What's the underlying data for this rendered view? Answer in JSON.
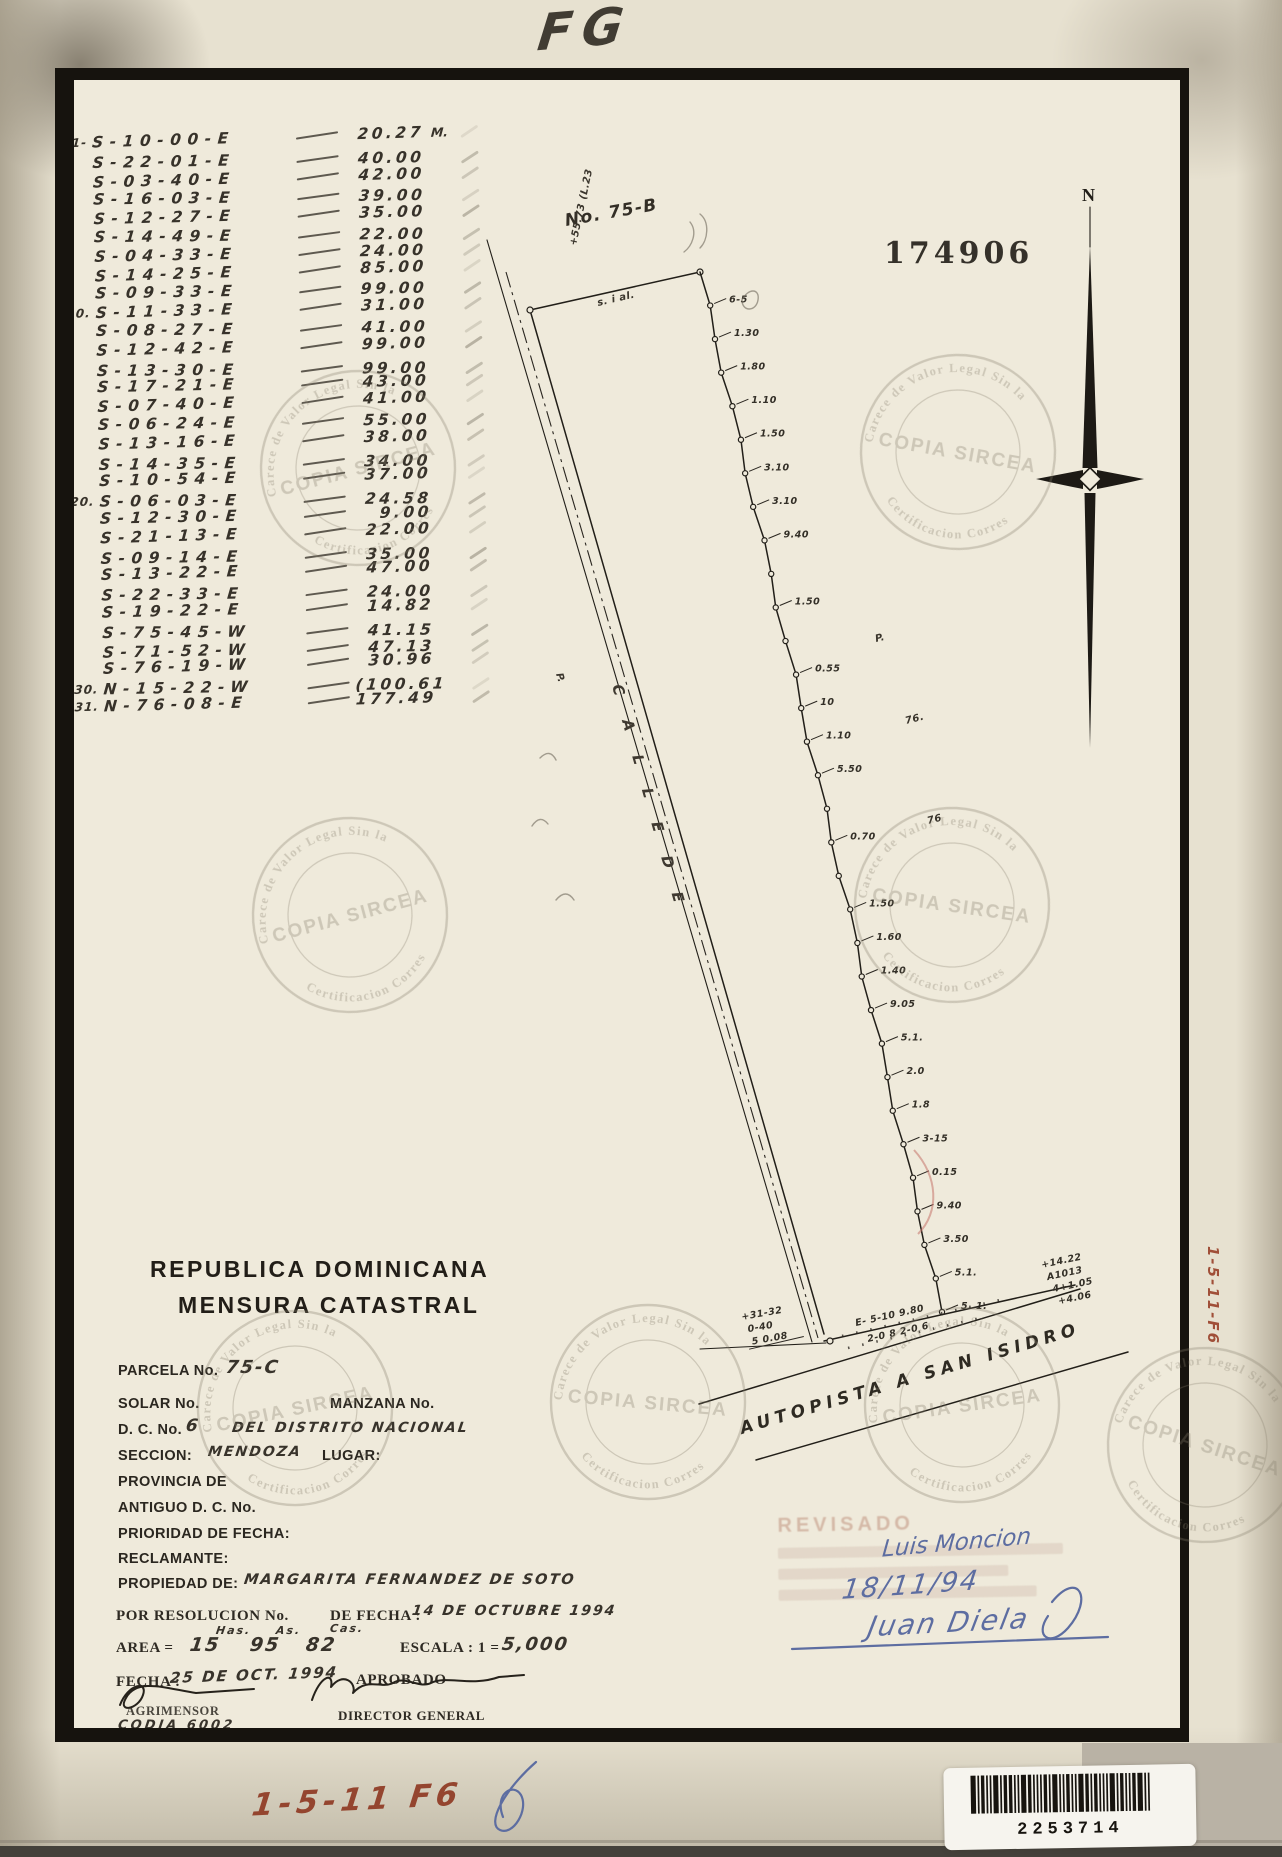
{
  "page": {
    "top_annotation": "FG",
    "stamp_number": "174906",
    "north_label": "N",
    "side_code": "1-5-11-F6",
    "bottom_code": "1-5-11 F6",
    "barcode_number": "2253714"
  },
  "watermark": {
    "ring_text_top": "Carece de Valor Legal Sin la",
    "ring_text_bottom": "Certificacion Correspondiente",
    "center_text": "COPIA SIRCEA"
  },
  "bearings": {
    "unit_first_row": "M.",
    "rows": [
      {
        "no": "1-",
        "bearing": "S-10-00-E",
        "distance": "20.27"
      },
      {
        "no": "",
        "bearing": "S-22-01-E",
        "distance": "40.00"
      },
      {
        "no": "",
        "bearing": "S-03-40-E",
        "distance": "42.00"
      },
      {
        "no": "",
        "bearing": "S-16-03-E",
        "distance": "39.00"
      },
      {
        "no": "",
        "bearing": "S-12-27-E",
        "distance": "35.00"
      },
      {
        "no": "",
        "bearing": "S-14-49-E",
        "distance": "22.00"
      },
      {
        "no": "",
        "bearing": "S-04-33-E",
        "distance": "24.00"
      },
      {
        "no": "",
        "bearing": "S-14-25-E",
        "distance": "85.00"
      },
      {
        "no": "",
        "bearing": "S-09-33-E",
        "distance": "99.00"
      },
      {
        "no": "10.",
        "bearing": "S-11-33-E",
        "distance": "31.00"
      },
      {
        "no": "",
        "bearing": "S-08-27-E",
        "distance": "41.00"
      },
      {
        "no": "",
        "bearing": "S-12-42-E",
        "distance": "99.00"
      },
      {
        "no": "",
        "bearing": "S-13-30-E",
        "distance": "99.00"
      },
      {
        "no": "",
        "bearing": "S-17-21-E",
        "distance": "43.00"
      },
      {
        "no": "",
        "bearing": "S-07-40-E",
        "distance": "41.00"
      },
      {
        "no": "",
        "bearing": "S-06-24-E",
        "distance": "55.00"
      },
      {
        "no": "",
        "bearing": "S-13-16-E",
        "distance": "38.00"
      },
      {
        "no": "",
        "bearing": "S-14-35-E",
        "distance": "34.00"
      },
      {
        "no": "",
        "bearing": "S-10-54-E",
        "distance": "37.00"
      },
      {
        "no": "20.",
        "bearing": "S-06-03-E",
        "distance": "24.58"
      },
      {
        "no": "",
        "bearing": "S-12-30-E",
        "distance": "9.00"
      },
      {
        "no": "",
        "bearing": "S-21-13-E",
        "distance": "22.00"
      },
      {
        "no": "",
        "bearing": "S-09-14-E",
        "distance": "35.00"
      },
      {
        "no": "",
        "bearing": "S-13-22-E",
        "distance": "47.00"
      },
      {
        "no": "",
        "bearing": "S-22-33-E",
        "distance": "24.00"
      },
      {
        "no": "",
        "bearing": "S-19-22-E",
        "distance": "14.82"
      },
      {
        "no": "",
        "bearing": "S-75-45-W",
        "distance": "41.15"
      },
      {
        "no": "",
        "bearing": "S-71-52-W",
        "distance": "47.13"
      },
      {
        "no": "",
        "bearing": "S-76-19-W",
        "distance": "30.96"
      },
      {
        "no": "30.",
        "bearing": "N-15-22-W",
        "distance": "(100.61"
      },
      {
        "no": "31.",
        "bearing": "N-76-08-E",
        "distance": "177.49"
      }
    ]
  },
  "drawing": {
    "parcel_label": "No. 75-B",
    "top_edge_note": "+55.73  (L.23",
    "top_line_note": "s. i al.",
    "road_left_label": "C A L L E   D E",
    "neighbor_mark_1": "P.",
    "neighbor_mark_2": "P.",
    "neighbor_mark_3": "76.",
    "neighbor_mark_4": "76",
    "east_ticks": [
      "6-5",
      "1.30",
      "1.80",
      "1.10",
      "1.50",
      "3.10",
      "3.10",
      "9.40",
      "",
      "1.50",
      "",
      "0.55",
      "10",
      "1.10",
      "5.50",
      "",
      "0.70",
      "",
      "1.50",
      "1.60",
      "1.40",
      "9.05",
      "5.1.",
      "2.0",
      "1.8",
      "3-15",
      "0.15",
      "9.40",
      "3.50",
      "5.1.",
      "5. 1."
    ],
    "bottom_left_stack": [
      "+31-32",
      "0-40",
      "5  0.08"
    ],
    "bottom_edge_note1": "E- 5-10   9.80",
    "bottom_edge_note2": "2-0 8    2-0 6",
    "bottom_right_stack": [
      "+14.22",
      "A1013",
      "4+1.05",
      "+4.06"
    ],
    "autopista_label": "AUTOPISTA   A   SAN  ISIDRO"
  },
  "titles": {
    "country": "REPUBLICA DOMINICANA",
    "doc": "MENSURA CATASTRAL"
  },
  "form": {
    "parcela_label": "PARCELA No.",
    "parcela_value": "75-C",
    "solar_label": "SOLAR No.",
    "manzana_label": "MANZANA No.",
    "dc_label": "D. C. No.",
    "dc_value": "6",
    "dc_text": "DEL DISTRITO NACIONAL",
    "seccion_label": "SECCION:",
    "seccion_value": "MENDOZA",
    "lugar_label": "LUGAR:",
    "provincia_label": "PROVINCIA DE",
    "antiguo_label": "ANTIGUO D. C. No.",
    "prioridad_label": "PRIORIDAD DE FECHA:",
    "reclamante_label": "RECLAMANTE:",
    "propiedad_label": "PROPIEDAD DE:",
    "propiedad_value": "MARGARITA  FERNANDEZ  DE  SOTO",
    "resolucion_label": "POR RESOLUCION No.",
    "de_fecha_label": "DE FECHA :",
    "de_fecha_value": "14 DE OCTUBRE 1994",
    "area_label": "AREA =",
    "area_has": "15",
    "area_has_unit": "Has.",
    "area_as": "95",
    "area_as_unit": "As.",
    "area_cas": "82",
    "area_cas_unit": "Cas.",
    "escala_label": "ESCALA : 1 =",
    "escala_value": "5,000",
    "fecha_label": "FECHA :",
    "fecha_value": "25 DE OCT. 1994",
    "aprobado_label": "APROBADO",
    "agrimensor_label": "AGRIMENSOR",
    "director_label": "DIRECTOR GENERAL",
    "codia": "CODIA 6002"
  },
  "revision": {
    "stamp_word": "REVISADO",
    "name": "Luis Moncion",
    "date": "18/11/94",
    "signature": "Juan Diela"
  }
}
